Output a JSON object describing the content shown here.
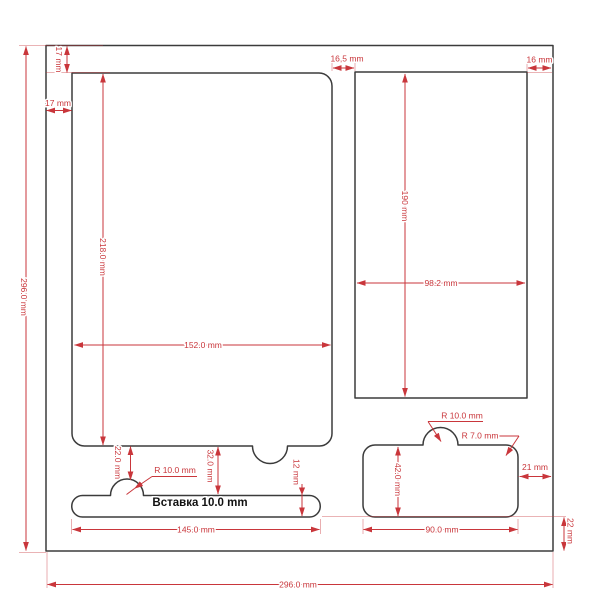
{
  "drawing": {
    "insert_label": "Вставка 10.0 mm",
    "dims": {
      "outer_height": "296.0 mm",
      "outer_width": "296.0 mm",
      "top_margin": "17 mm",
      "left_margin": "17 mm",
      "pocket_gap": "16,5 mm",
      "right_margin": "16 mm",
      "left_pocket_height": "218.0 mm",
      "left_pocket_width": "152.0 mm",
      "right_pocket_height": "190 mm",
      "right_pocket_width": "98.2 mm",
      "strip_notch_radius": "R 10.0 mm",
      "strip_top_offset": "22.0 mm",
      "strip_gap": "32.0 mm",
      "strip_height": "12 mm",
      "strip_width": "145.0 mm",
      "small_pocket_notch_radius": "R 10.0 mm",
      "small_pocket_corner_radius": "R 7.0 mm",
      "small_pocket_height": "42.0 mm",
      "small_pocket_width": "90.0 mm",
      "small_pocket_right_margin": "21 mm",
      "bottom_margin": "22 mm"
    },
    "colors": {
      "dimension": "#c9363b",
      "outline": "#3b3b3b",
      "insert_text": "#111111",
      "background": "#ffffff"
    }
  }
}
